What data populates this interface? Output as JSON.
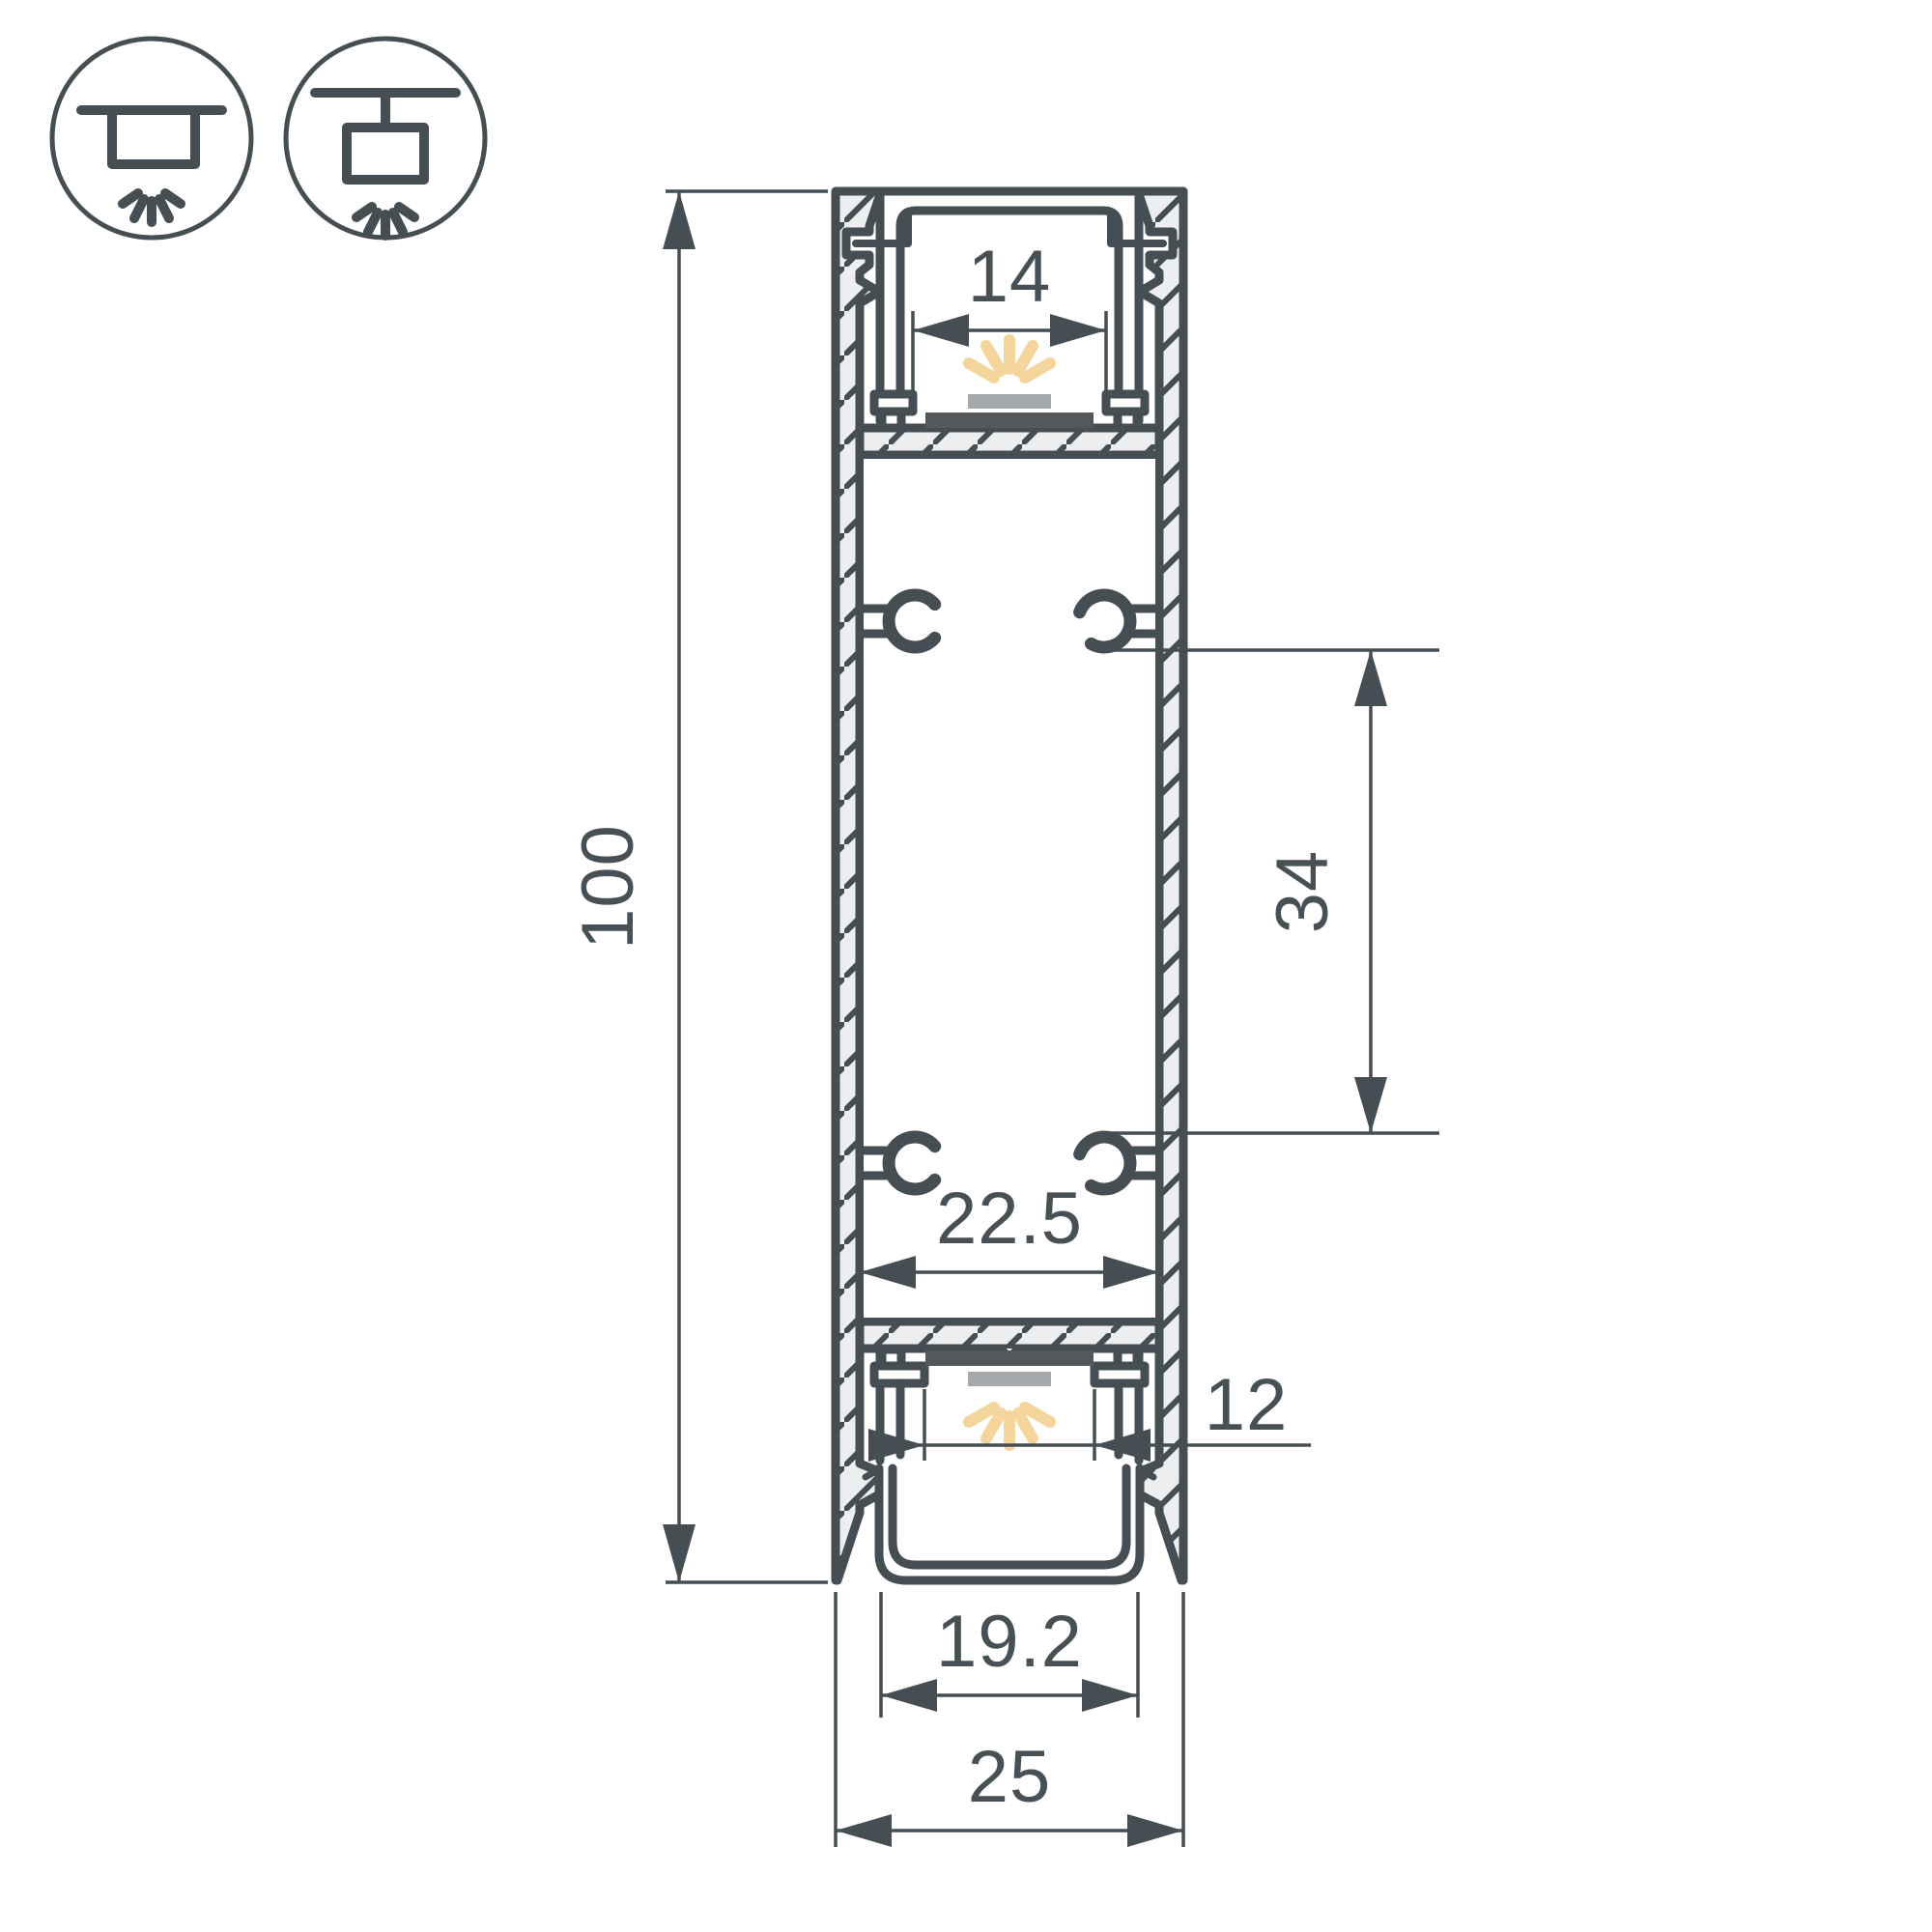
{
  "title": "LED aluminium profile cross-section drawing",
  "icons": {
    "recessed_mount": "recessed-ceiling-mount-icon",
    "surface_mount": "surface-ceiling-mount-icon"
  },
  "dims": {
    "height": "100",
    "top_opening": "14",
    "mount_spacing": "34",
    "inner_width": "22.5",
    "bottom_opening": "12",
    "diffuser_width": "19.2",
    "overall_width": "25"
  },
  "colors": {
    "line": "#454E53",
    "wall_fill": "#ECEEEF",
    "pcb": "#54585B",
    "led": "#A5A9AC",
    "glow": "#F4D69C",
    "background": "#FFFFFF"
  }
}
